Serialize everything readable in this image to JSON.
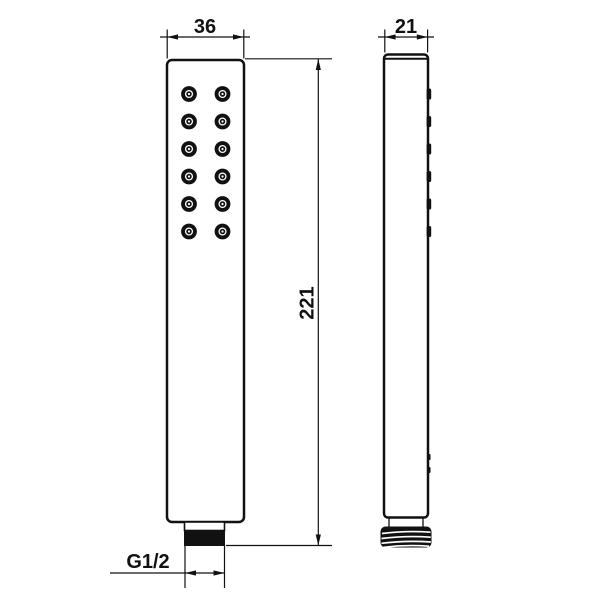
{
  "drawing": {
    "type": "technical-drawing",
    "subject": "handheld-shower-head",
    "colors": {
      "ink": "#111111",
      "paper": "#ffffff"
    },
    "dimensions": {
      "front_width": "36",
      "side_width": "21",
      "height": "221",
      "thread_size": "G1/2"
    },
    "front_view": {
      "nozzle_rows": 6,
      "nozzle_cols": 2
    },
    "side_view": {
      "nozzle_mark_count": 6,
      "clip_mark_count": 2
    }
  }
}
